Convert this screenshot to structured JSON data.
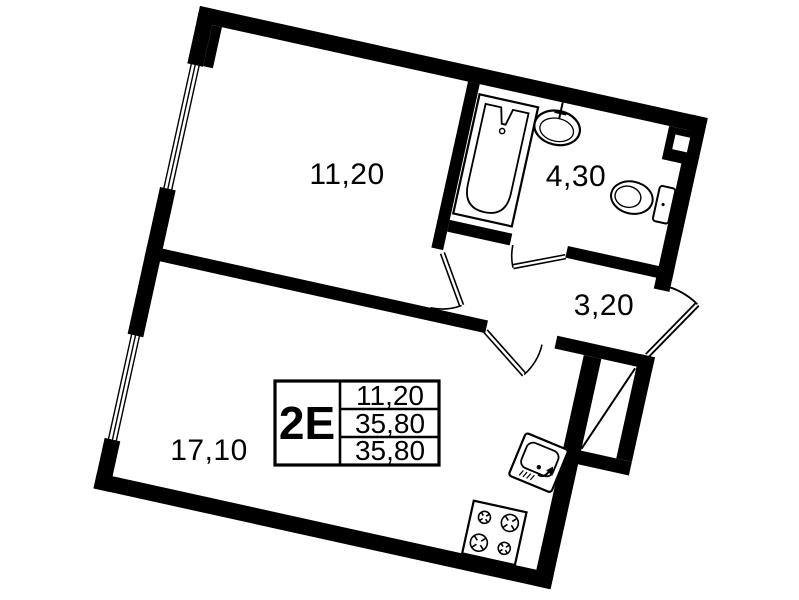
{
  "floor_plan": {
    "unit_label": "2E",
    "info_box": {
      "rows": [
        "11,20",
        "35,80",
        "35,80"
      ]
    },
    "rooms": [
      {
        "id": "bedroom",
        "area": "11,20"
      },
      {
        "id": "bathroom",
        "area": "4,30"
      },
      {
        "id": "hallway",
        "area": "3,20"
      },
      {
        "id": "living-kitchen",
        "area": "17,10"
      }
    ],
    "colors": {
      "walls": "#000000",
      "background": "#ffffff"
    }
  }
}
